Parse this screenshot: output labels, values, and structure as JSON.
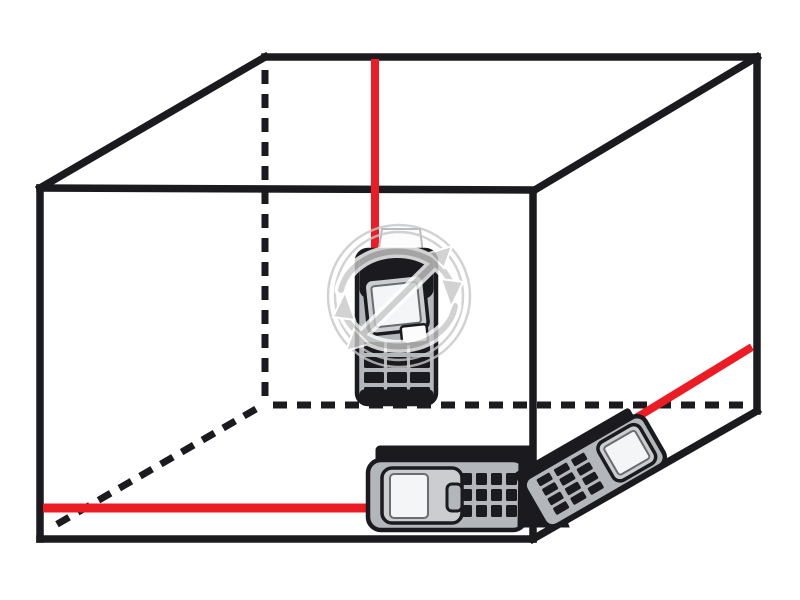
{
  "meta": {
    "description": "Illustration of a room interior drawn as a wireframe box with three laser distance meters projecting red laser measurement lines: one vertical line to the ceiling, one horizontal line along the floor to the left wall, and one diagonal line to the right wall edge. A circular gray watermark logo overlays the center device.",
    "width": 800,
    "height": 600
  },
  "colors": {
    "background": "#ffffff",
    "outline": "#1b1a1e",
    "laser": "#ED1C24",
    "device_body": "#b3b6ba",
    "device_bezel": "#cbcdd0",
    "device_screen": "#f4f5f6",
    "screen_border": "#6a6d70",
    "cap_fill": "#fcfcfc",
    "cap_border": "#b9bcbe",
    "watermark": "#c7c7c7"
  },
  "room": {
    "corners": {
      "back_top_left": [
        265,
        57
      ],
      "back_top_right": [
        757,
        57
      ],
      "front_top_left": [
        40,
        188
      ],
      "front_top_right": [
        533,
        191
      ],
      "front_bottom_left": [
        40,
        539
      ],
      "front_bottom_right": [
        533,
        539
      ],
      "back_bottom_right": [
        757,
        411
      ],
      "back_bottom_left_hidden": [
        265,
        404
      ]
    },
    "solid_edges": [
      [
        265,
        57,
        757,
        57
      ],
      [
        757,
        57,
        533,
        191
      ],
      [
        533,
        190,
        40,
        188
      ],
      [
        40,
        188,
        265,
        57
      ],
      [
        40,
        188,
        40,
        539
      ],
      [
        40,
        539,
        533,
        539
      ],
      [
        533,
        191,
        533,
        539
      ],
      [
        533,
        539,
        757,
        411
      ],
      [
        757,
        57,
        757,
        411
      ]
    ],
    "hidden_edges": [
      [
        265,
        70,
        265,
        401
      ],
      [
        273,
        405,
        748,
        405
      ],
      [
        256,
        409,
        54,
        526
      ]
    ]
  },
  "lasers": [
    {
      "name": "ceiling-laser-beam",
      "from": [
        375,
        59
      ],
      "to": [
        375,
        253
      ],
      "width": 8
    },
    {
      "name": "floor-laser-beam",
      "from": [
        43,
        508
      ],
      "to": [
        377,
        508
      ],
      "width": 9
    },
    {
      "name": "diagonal-laser-beam",
      "from": [
        636,
        418
      ],
      "to": [
        752,
        347
      ],
      "width": 8
    }
  ],
  "devices": [
    {
      "name": "laser-meter-vertical",
      "keypad": {
        "layer": "kp-dev1",
        "x": 364,
        "y": 342,
        "cols": 3,
        "rows": 4,
        "key_w": 20,
        "key_h": 11,
        "gap_x": 3,
        "gap_y": 4
      }
    },
    {
      "name": "laser-meter-floor",
      "keypad": {
        "layer": "kp-dev2",
        "x": 461,
        "y": 473,
        "cols": 4,
        "rows": 3,
        "key_w": 11,
        "key_h": 12,
        "gap_x": 4,
        "gap_y": 4
      }
    },
    {
      "name": "laser-meter-tilted",
      "keypad": {
        "layer": "kp-dev3",
        "x": 14,
        "y": -50,
        "cols": 3,
        "rows": 4,
        "key_w": 15,
        "key_h": 8,
        "gap_x": 5,
        "gap_y": 3
      }
    }
  ],
  "watermark": {
    "shape": "double-circle with curved arrows and diagonal double-headed arrow",
    "center": [
      399,
      296
    ],
    "outer_radius": 71,
    "inner_radius": 64,
    "opacity": 0.8
  }
}
